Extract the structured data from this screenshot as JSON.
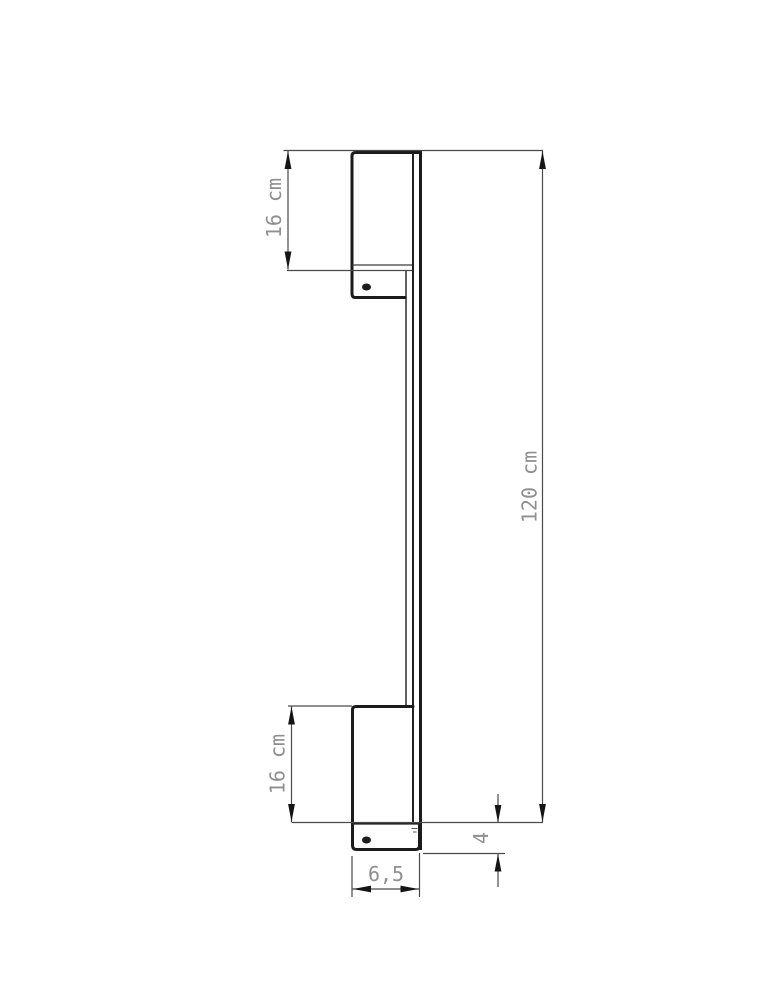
{
  "drawing": {
    "kind": "technical-dimension-drawing",
    "subject": "wall-mounted linear lamp, side profile view with two mounting brackets",
    "colors": {
      "outline": "#1b1b1b",
      "dimension_line": "#4a4a4a",
      "text": "#8f8f8f"
    },
    "dimensions": {
      "top_bracket_height": "16 cm",
      "total_height": "120 cm",
      "bottom_bracket_height": "16 cm",
      "foot_height": "4",
      "bracket_depth": "6,5"
    }
  }
}
